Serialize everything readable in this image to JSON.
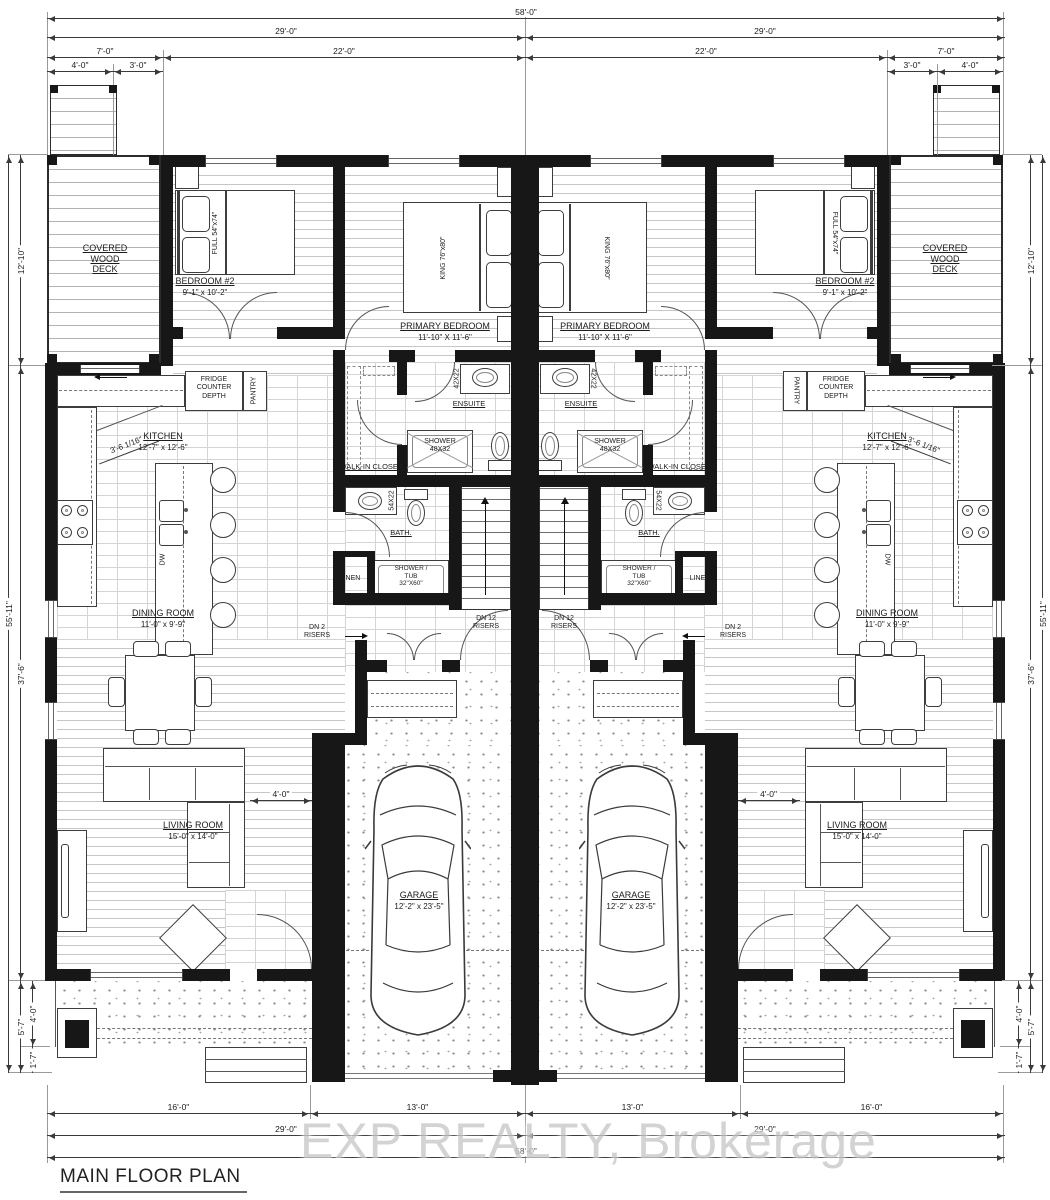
{
  "title": "MAIN FLOOR PLAN",
  "watermark": "EXP REALTY, Brokerage",
  "dims": {
    "overall": "58'-0\"",
    "half": "29'-0\"",
    "deck_total": "7'-0\"",
    "deck_stair": "4'-0\"",
    "deck_rest": "3'-0\"",
    "unit_width": "22'-0\"",
    "deck_depth": "12'-10\"",
    "side_total": "55'-11\"",
    "main_depth": "37'-6\"",
    "porch_total": "5'-7\"",
    "porch_depth": "4'-0\"",
    "porch_steps": "1'-7\"",
    "front_living": "16'-0\"",
    "front_garage": "13'-0\"",
    "kitchen_corner": "3'-6 1/16\"",
    "living_clear": "4'-0\""
  },
  "rooms": {
    "deck": {
      "name": "COVERED\nWOOD\nDECK"
    },
    "bedroom2": {
      "name": "BEDROOM #2",
      "size": "9'-1\" x 10'-2\""
    },
    "primary": {
      "name": "PRIMARY BEDROOM",
      "size": "11'-10\" X 11'-6\""
    },
    "ensuite": {
      "name": "ENSUITE"
    },
    "wic": {
      "name": "WALK-IN CLOSET"
    },
    "bath": {
      "name": "BATH."
    },
    "linen": {
      "name": "LINEN"
    },
    "kitchen": {
      "name": "KITCHEN",
      "size": "12'-7\" x 12'-6\""
    },
    "dining": {
      "name": "DINING ROOM",
      "size": "11'-0\" x 9'-9\""
    },
    "living": {
      "name": "LIVING ROOM",
      "size": "15'-0\" x 14'-0\""
    },
    "garage": {
      "name": "GARAGE",
      "size": "12'-2\" x 23'-5\""
    }
  },
  "fixtures": {
    "bed_full": "FULL 54\"x74\"",
    "bed_king": "KING 76\"x80\"",
    "fridge": "FRIDGE\nCOUNTER\nDEPTH",
    "pantry": "PANTRY",
    "dishwasher": "DW",
    "ensuite_vanity": "42X22",
    "bath_vanity": "54X22",
    "shower": "SHOWER\n48X32",
    "shower_tub": "SHOWER /\nTUB\n32\"X60\"",
    "stairs_main": "DN 12\nRISERS",
    "stairs_garage": "DN 2\nRISERS"
  }
}
